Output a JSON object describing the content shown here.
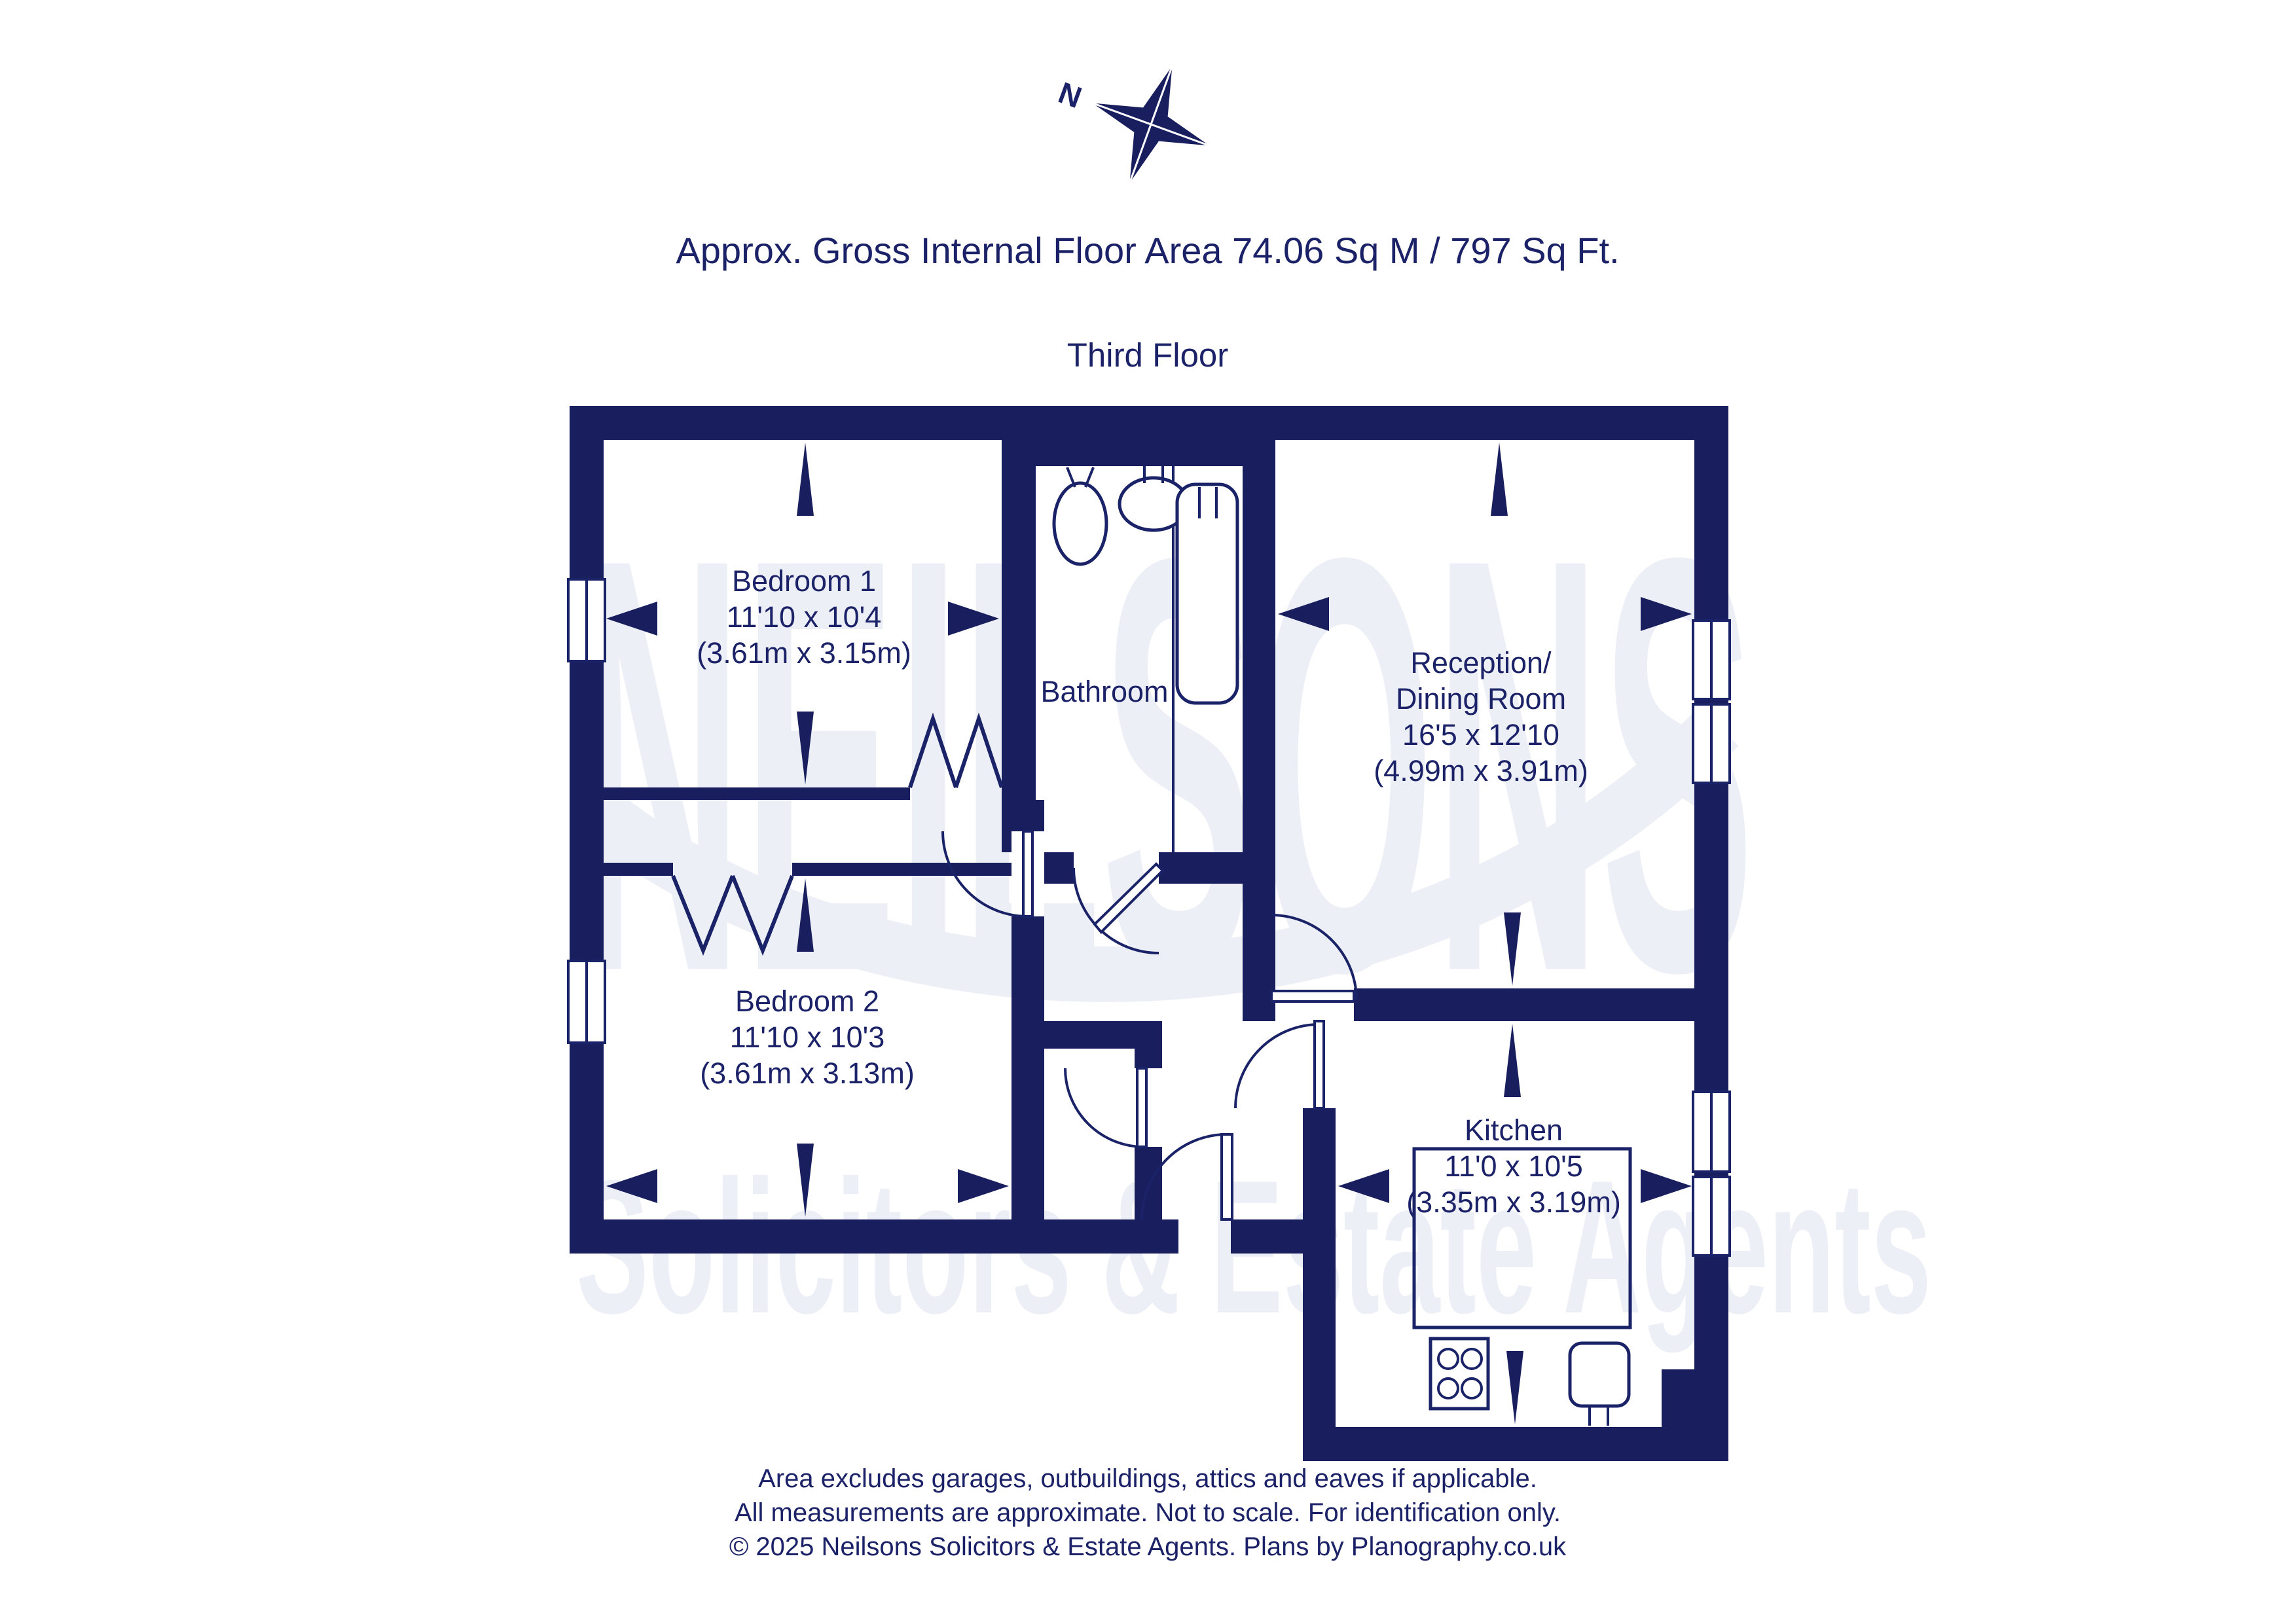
{
  "header": {
    "area_line": "Approx. Gross Internal Floor Area 74.06 Sq M / 797 Sq Ft.",
    "floor_line": "Third Floor"
  },
  "compass": {
    "north_label": "N"
  },
  "watermark": {
    "line1": "NEILSONS",
    "line2": "Solicitors & Estate Agents"
  },
  "plan": {
    "rooms": [
      {
        "id": "bedroom-1",
        "label_lines": [
          "Bedroom 1",
          "11'10 x 10'4",
          "(3.61m x 3.15m)"
        ]
      },
      {
        "id": "bathroom",
        "label_lines": [
          "Bathroom"
        ]
      },
      {
        "id": "reception-dining",
        "label_lines": [
          "Reception/",
          "Dining Room",
          "16'5 x 12'10",
          "(4.99m x 3.91m)"
        ]
      },
      {
        "id": "bedroom-2",
        "label_lines": [
          "Bedroom 2",
          "11'10 x 10'3",
          "(3.61m x 3.13m)"
        ]
      },
      {
        "id": "kitchen",
        "label_lines": [
          "Kitchen",
          "11'0 x 10'5",
          "(3.35m x 3.19m)"
        ]
      }
    ]
  },
  "footer": {
    "line1": "Area excludes garages, outbuildings, attics and eaves if applicable.",
    "line2": "All measurements are approximate. Not to scale. For identification only.",
    "line3": "© 2025 Neilsons Solicitors & Estate Agents. Plans by Planography.co.uk"
  },
  "colors": {
    "wall_navy": "#191f5e",
    "text_navy": "#1c2268",
    "watermark": "#edeff6",
    "background": "#ffffff"
  }
}
